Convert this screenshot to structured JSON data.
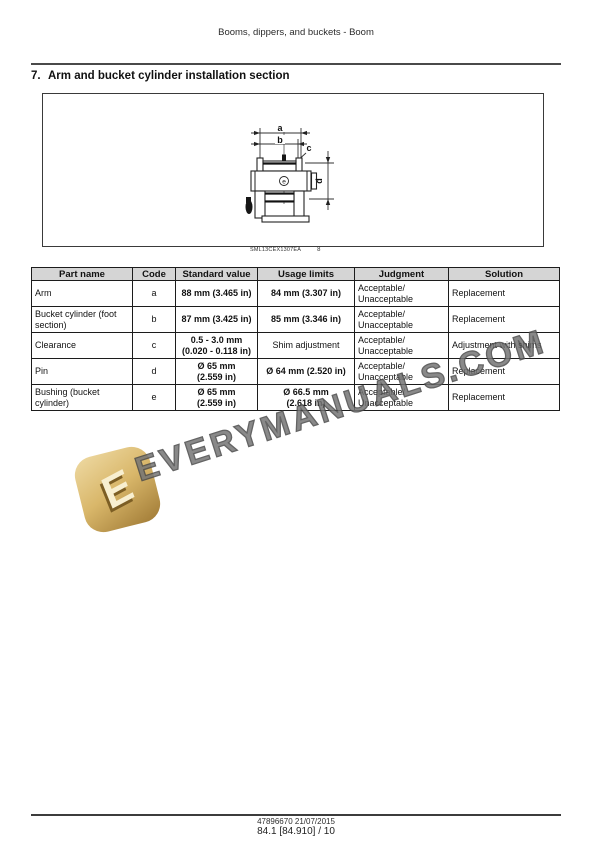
{
  "doc_header": "Booms, dippers, and buckets - Boom",
  "section": {
    "number": "7.",
    "title": "Arm and bucket cylinder installation section"
  },
  "figure": {
    "caption_code": "SML13CEX1307EA",
    "caption_index": "8",
    "labels": {
      "a": "a",
      "b": "b",
      "c": "c",
      "d": "d",
      "e": "e"
    }
  },
  "table": {
    "headers": [
      "Part name",
      "Code",
      "Standard value",
      "Usage limits",
      "Judgment",
      "Solution"
    ],
    "rows": [
      [
        "Arm",
        "a",
        "88 mm (3.465 in)",
        "84 mm (3.307 in)",
        "Acceptable/\nUnacceptable",
        "Replacement"
      ],
      [
        "Bucket cylinder (foot section)",
        "b",
        "87 mm (3.425 in)",
        "85 mm (3.346 in)",
        "Acceptable/\nUnacceptable",
        "Replacement"
      ],
      [
        "Clearance",
        "c",
        "0.5 - 3.0 mm\n(0.020 - 0.118 in)",
        "Shim adjustment",
        "Acceptable/\nUnacceptable",
        "Adjustment with shims"
      ],
      [
        "Pin",
        "d",
        "Ø 65 mm\n(2.559 in)",
        "Ø 64 mm (2.520 in)",
        "Acceptable/\nUnacceptable",
        "Replacement"
      ],
      [
        "Bushing (bucket cylinder)",
        "e",
        "Ø 65 mm\n(2.559 in)",
        "Ø 66.5 mm\n(2.618 in)",
        "Acceptable/\nUnacceptable",
        "Replacement"
      ]
    ]
  },
  "watermark": {
    "text": "EVERYMANUALS.COM",
    "logo_letter": "E",
    "gold_color": "#c9a254",
    "text_color": "#757575"
  },
  "footer": {
    "line1": "47896670 21/07/2015",
    "line2": "84.1 [84.910] / 10"
  }
}
